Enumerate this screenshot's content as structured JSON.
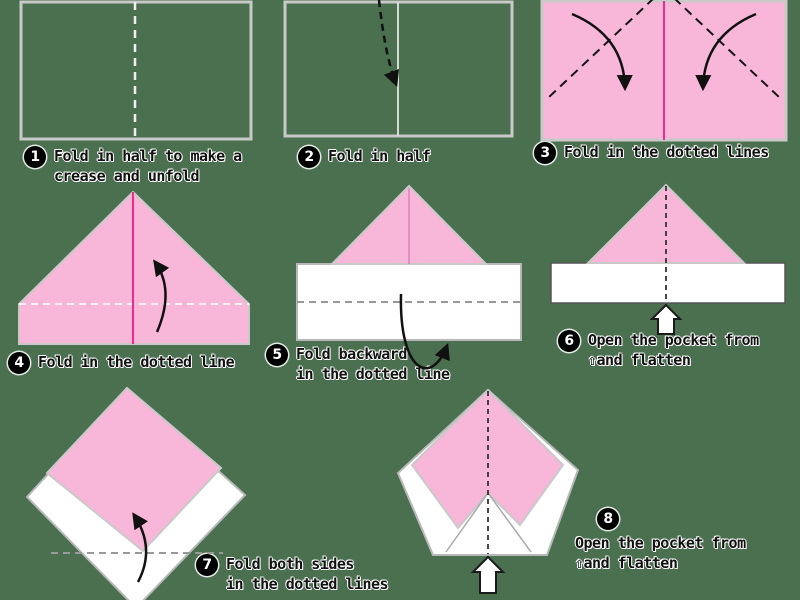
{
  "colors": {
    "background": "#4a7050",
    "paper-pink": "#f8b7d8",
    "paper-white": "#ffffff",
    "crease-magenta": "#ee2a90",
    "outline-silver": "#c9c9c9",
    "text-black": "#111111",
    "badge-black": "#000000"
  },
  "steps": [
    {
      "number": "1",
      "lines": [
        "Fold in half to make a",
        "crease and unfold"
      ]
    },
    {
      "number": "2",
      "lines": [
        "Fold in half"
      ]
    },
    {
      "number": "3",
      "lines": [
        "Fold in the dotted lines"
      ]
    },
    {
      "number": "4",
      "lines": [
        "Fold in the dotted line"
      ]
    },
    {
      "number": "5",
      "lines": [
        "Fold backward",
        "in the dotted line"
      ]
    },
    {
      "number": "6",
      "lines": [
        "Open the pocket from",
        "⇧and flatten"
      ]
    },
    {
      "number": "7",
      "lines": [
        "Fold both sides",
        "in the dotted lines"
      ]
    },
    {
      "number": "8",
      "lines": [
        "Open the pocket from",
        "⇧and flatten"
      ]
    }
  ]
}
